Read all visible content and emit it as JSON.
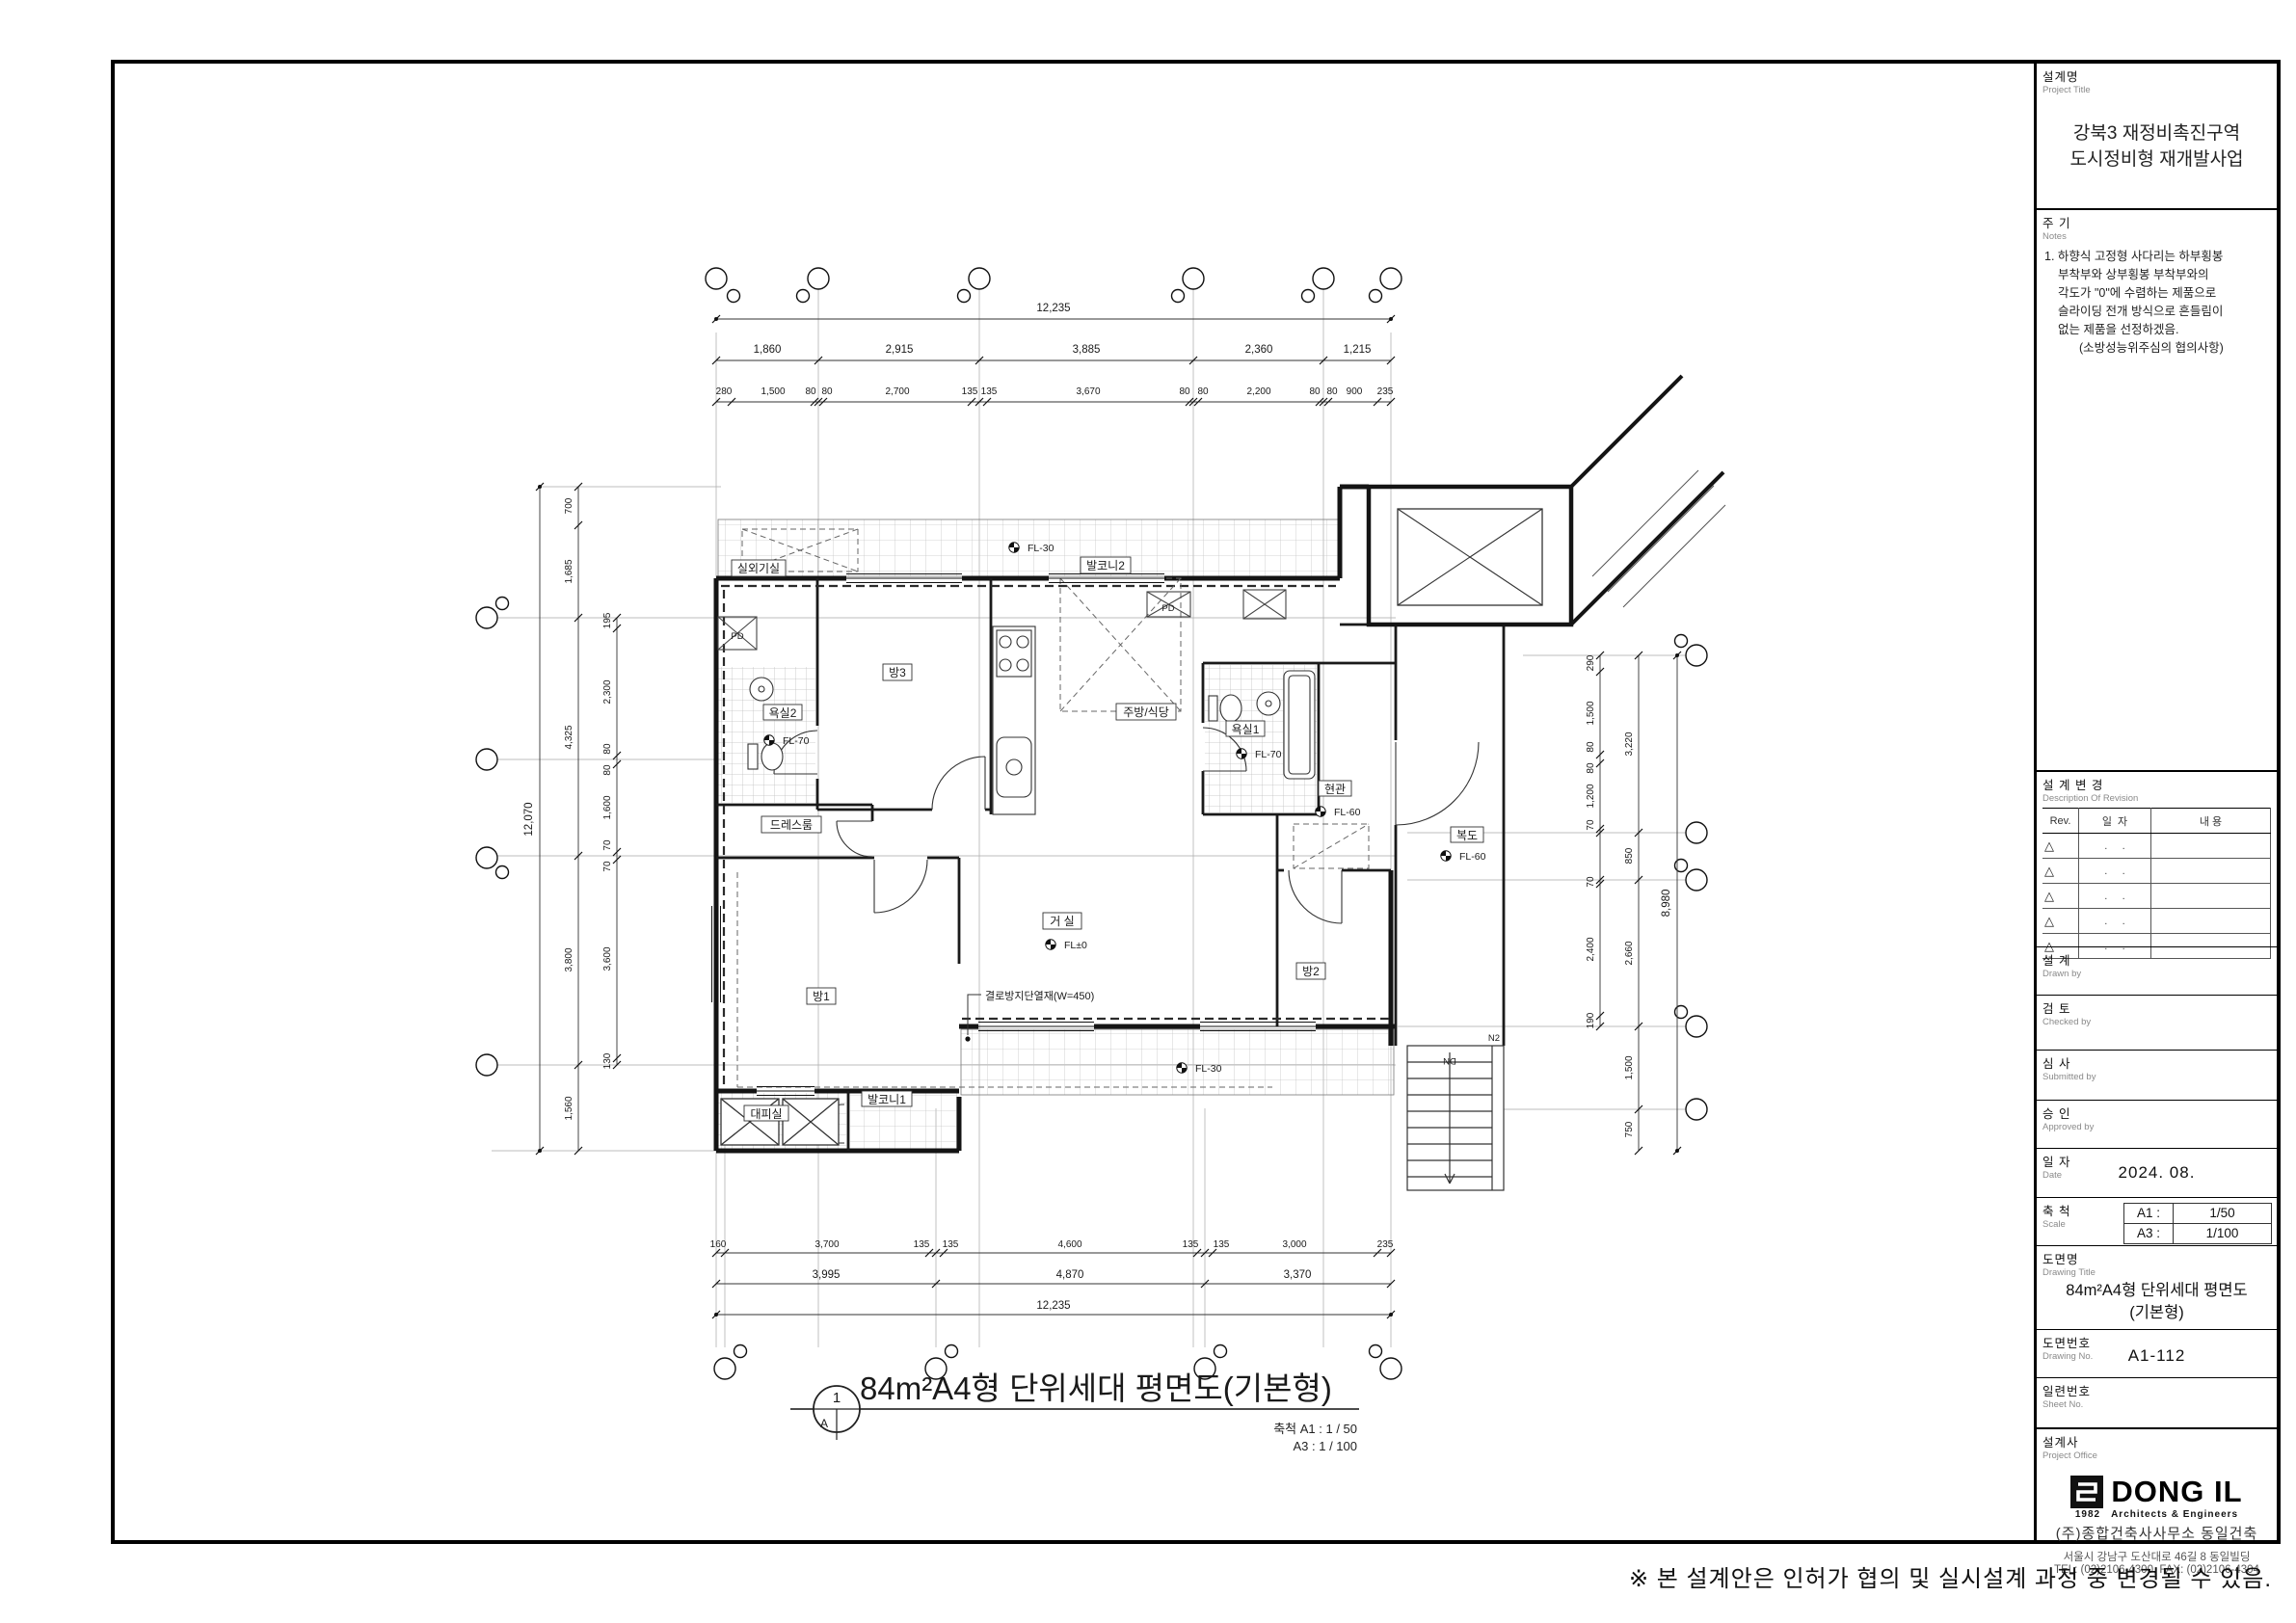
{
  "tb": {
    "project": {
      "ko": "설계명",
      "en": "Project Title",
      "line1": "강북3 재정비촉진구역",
      "line2": "도시정비형 재개발사업"
    },
    "notes": {
      "ko": "주 기",
      "en": "Notes",
      "lines": [
        "1. 하향식 고정형 사다리는 하부횡봉",
        "부착부와 상부횡봉 부착부와의",
        "각도가 \"0\"에 수렴하는 제품으로",
        "슬라이딩 전개 방식으로 흔들림이",
        "없는 제품을 선정하겠음.",
        "(소방성능위주심의 협의사항)"
      ]
    },
    "revision": {
      "ko": "설 계 변 경",
      "en": "Description  Of  Revision",
      "headers": [
        "Rev.",
        "일  자",
        "내  용"
      ],
      "rows": [
        {
          "sym": "△",
          "date": ".     ."
        },
        {
          "sym": "△",
          "date": ".     ."
        },
        {
          "sym": "△",
          "date": ".     ."
        },
        {
          "sym": "△",
          "date": ".     ."
        },
        {
          "sym": "△",
          "date": ".     ."
        }
      ]
    },
    "drawn": {
      "ko": "설 계",
      "en": "Drawn by"
    },
    "checked": {
      "ko": "검 토",
      "en": "Checked by"
    },
    "submitted": {
      "ko": "심 사",
      "en": "Submitted by"
    },
    "approved": {
      "ko": "승 인",
      "en": "Approved by"
    },
    "date": {
      "ko": "일 자",
      "en": "Date",
      "value": "2024. 08."
    },
    "scale": {
      "ko": "축 척",
      "en": "Scale",
      "rows": [
        {
          "k": "A1 :",
          "v": "1/50"
        },
        {
          "k": "A3 :",
          "v": "1/100"
        }
      ]
    },
    "dwg_title": {
      "ko": "도면명",
      "en": "Drawing Title",
      "line1": "84m²A4형 단위세대 평면도",
      "line2": "(기본형)"
    },
    "dwg_no": {
      "ko": "도면번호",
      "en": "Drawing No.",
      "value": "A1-112"
    },
    "sheet_no": {
      "ko": "일련번호",
      "en": "Sheet No."
    },
    "office": {
      "ko": "설계사",
      "en": "Project Office",
      "logo": "DONG IL",
      "year": "1982",
      "tagline": "Architects & Engineers",
      "name": "(주)종합건축사사무소 동일건축",
      "addr": "서울시 강남구 도산대로 46길 8 동일빌딩",
      "tel": "TEL: (02)2106-4300, FAX: (02)2106-4304"
    }
  },
  "plan_title": {
    "num": "1",
    "letter": "A",
    "text": "84m²A4형 단위세대 평면도(기본형)",
    "scale_a1": "축척 A1 : 1 /    50",
    "scale_a3": "A3 : 1 /  100"
  },
  "footer": {
    "note": "※ 본 설계안은 인허가 협의 및 실시설계 과정 중 변경될 수 있음."
  },
  "plan": {
    "labels": {
      "outdoor_unit": "실외기실",
      "balcony2": "발코니2",
      "room3": "방3",
      "bath2": "욕실2",
      "kitchen": "주방/식당",
      "bath1": "욕실1",
      "dress": "드레스룸",
      "entry": "현관",
      "corridor": "복도",
      "living": "거 실",
      "room1": "방1",
      "room2": "방2",
      "shelter": "대피실",
      "balcony1": "발코니1",
      "pd": "PD",
      "dn": "DN",
      "n2": "N2"
    },
    "fl": {
      "fl30": "FL-30",
      "fl70": "FL-70",
      "fl60": "FL-60",
      "fl0": "FL±0"
    },
    "insulation": "결로방지단열재(W=450)"
  },
  "dims": {
    "top_total": "12,235",
    "top_major": [
      "1,860",
      "2,915",
      "3,885",
      "2,360",
      "1,215"
    ],
    "top_minor": [
      "280",
      "1,500",
      "80",
      "80",
      "2,700",
      "135",
      "135",
      "3,670",
      "80",
      "80",
      "2,200",
      "80",
      "80",
      "900",
      "235"
    ],
    "bottom_minor": [
      "160",
      "3,700",
      "135",
      "135",
      "4,600",
      "135",
      "135",
      "3,000",
      "235"
    ],
    "bottom_major": [
      "3,995",
      "4,870",
      "3,370"
    ],
    "bottom_total": "12,235",
    "left_total": "12,070",
    "left_major": [
      "700",
      "1,685",
      "4,325",
      "3,800",
      "1,560"
    ],
    "left_minor": [
      "195",
      "2,300",
      "80",
      "80",
      "1,600",
      "70",
      "70",
      "3,600",
      "130"
    ],
    "right_minor": [
      "290",
      "1,500",
      "80",
      "80",
      "1,200",
      "70",
      "70",
      "2,400",
      "190"
    ],
    "right_major": [
      "3,220",
      "850",
      "2,660",
      "1,500",
      "750"
    ],
    "right_total": "8,980"
  }
}
